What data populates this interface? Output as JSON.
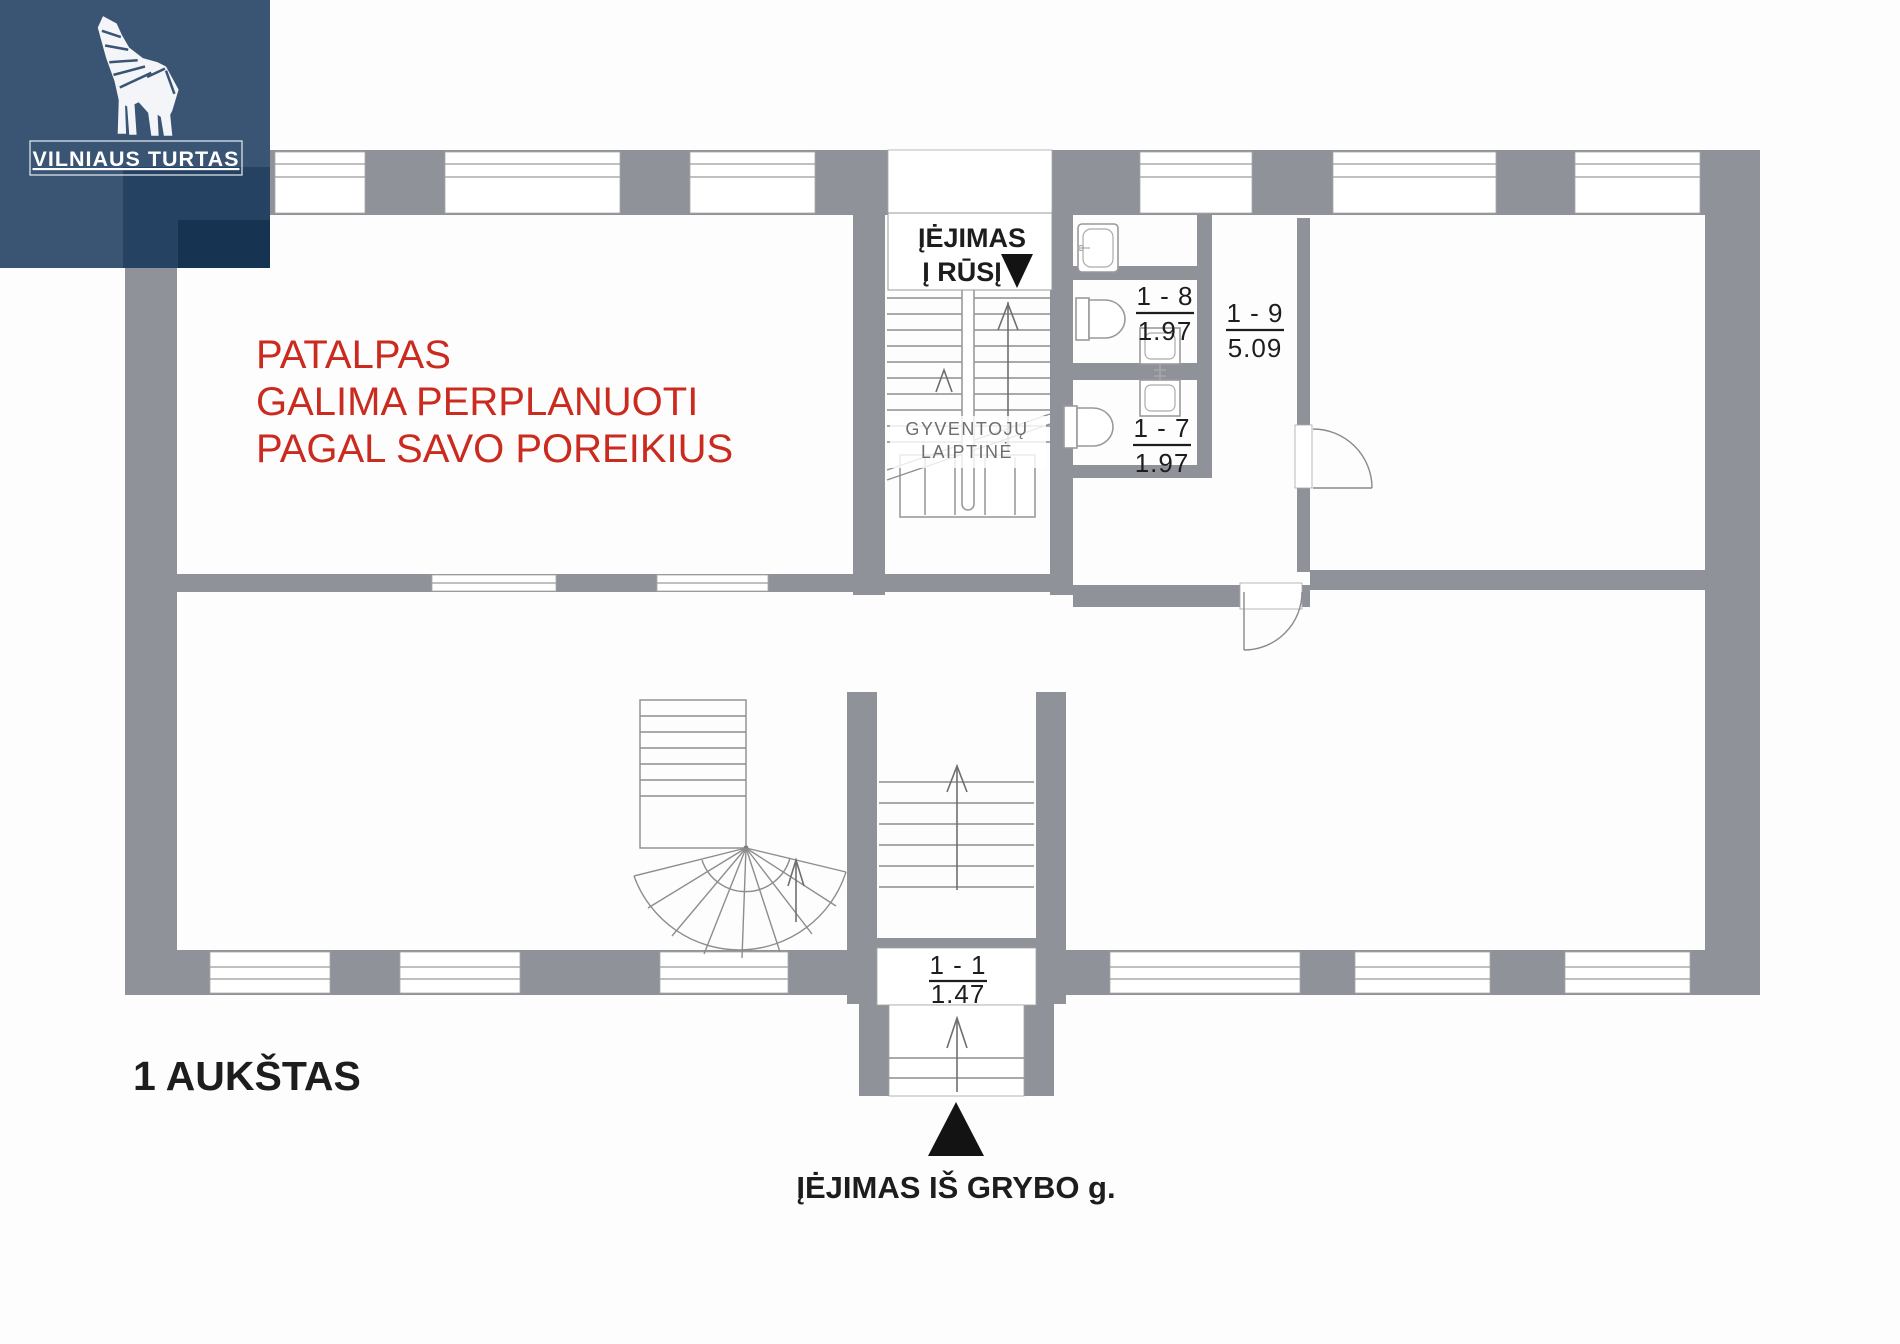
{
  "brand": {
    "name": "VILNIAUS TURTAS"
  },
  "notice": {
    "lines": [
      "PATALPAS",
      "GALIMA PERPLANUOTI",
      "PAGAL SAVO POREIKIUS"
    ],
    "color": "#cb2a1f"
  },
  "floor": {
    "label": "1 AUKŠTAS"
  },
  "entrance": {
    "street_label": "ĮĖJIMAS IŠ GRYBO g."
  },
  "basement_entrance": {
    "line1": "ĮĖJIMAS",
    "line2": "Į RŪSĮ"
  },
  "stairwell": {
    "line1": "GYVENTOJŲ",
    "line2": "LAIPTINĖ"
  },
  "rooms": [
    {
      "id": "1 - 8",
      "area": "1.97"
    },
    {
      "id": "1 - 7",
      "area": "1.97"
    },
    {
      "id": "1 - 9",
      "area": "5.09"
    },
    {
      "id": "1 - 1",
      "area": "1.47"
    }
  ],
  "icons": {
    "logo_icon": "geometric-wolf",
    "basement_marker": "down-triangle",
    "entrance_marker": "up-triangle"
  },
  "colors": {
    "wall": "#8f9399",
    "logo_bg": "#3a5474",
    "logo_overlay": "#0e2c4e",
    "notice_red": "#cb2a1f",
    "marker_black": "#131313"
  }
}
